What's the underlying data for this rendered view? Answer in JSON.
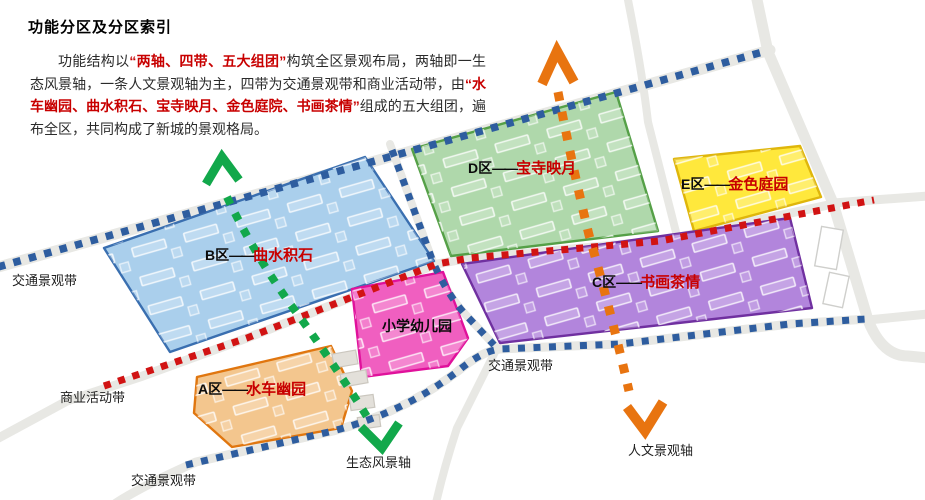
{
  "header": {
    "title": "功能分区及分区索引"
  },
  "intro": {
    "seg1": "功能结构以",
    "seg2": "“两轴、四带、五大组团”",
    "seg3": "构筑全区景观布局，两轴即一生态风景轴，一条人文景观轴为主，四带为交通景观带和商业活动带，由",
    "seg4": "“水车幽园、曲水积石、宝寺映月、金色庭院、书画茶情”",
    "seg5": "组成的五大组团，遍布全区，共同构成了新城的景观格局。"
  },
  "zones": {
    "a": {
      "code": "A区",
      "dash": "——",
      "name": "水车幽园",
      "fill": "#f3c68e",
      "border": "#e0760f"
    },
    "b": {
      "code": "B区",
      "dash": "——",
      "name": "曲水积石",
      "fill": "#aacfec",
      "border": "#3a6fb0"
    },
    "c": {
      "code": "C区",
      "dash": "——",
      "name": "书画茶情",
      "fill": "#b285dc",
      "border": "#7030a0"
    },
    "d": {
      "code": "D区",
      "dash": "——",
      "name": "宝寺映月",
      "fill": "#afd8ab",
      "border": "#55a047"
    },
    "e": {
      "code": "E区",
      "dash": "——",
      "name": "金色庭园",
      "fill": "#ffe83c",
      "border": "#dfb60b"
    },
    "school": {
      "name": "小学幼儿园",
      "fill": "#f05fc0",
      "border": "#e0119b"
    }
  },
  "belts": {
    "traffic": "交通景观带",
    "commercial": "商业活动带",
    "traffic_color": "#2e5d9f",
    "commercial_color": "#d11313"
  },
  "axes": {
    "eco": {
      "label": "生态风景轴",
      "color": "#12a84b"
    },
    "human": {
      "label": "人文景观轴",
      "color": "#e87410"
    }
  }
}
